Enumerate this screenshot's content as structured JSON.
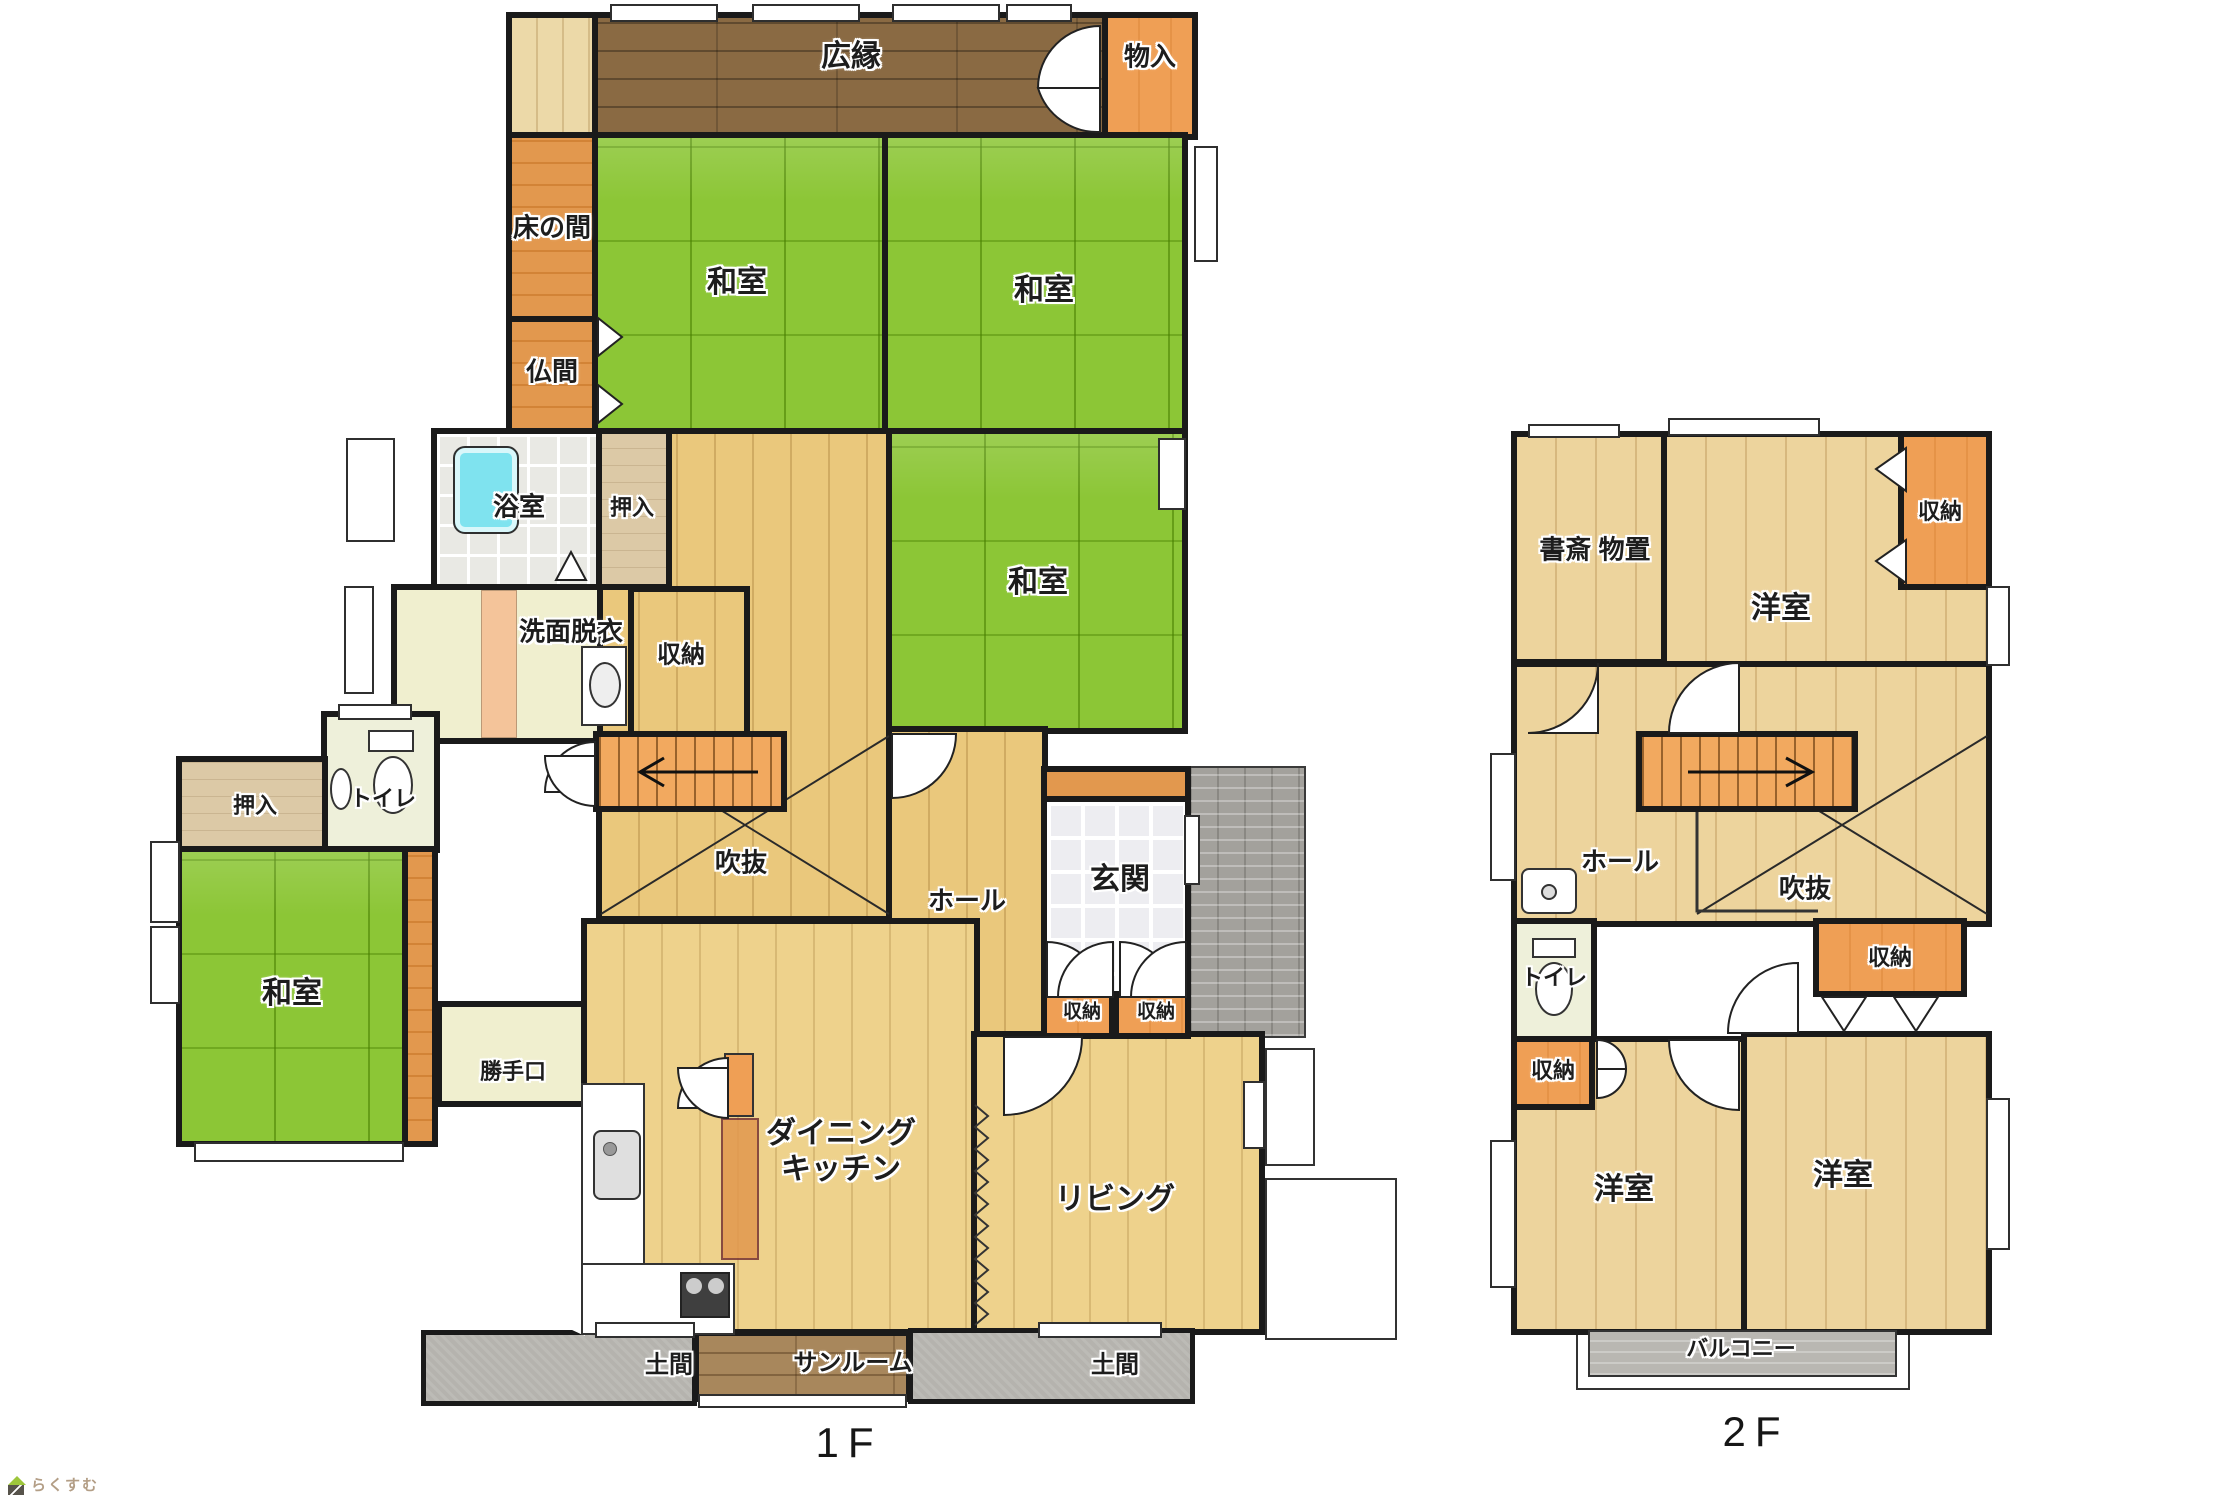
{
  "floor1": {
    "hiroen": "広縁",
    "monoire": "物入",
    "tokonoma": "床の間",
    "butsuma": "仏間",
    "washitsu_nw": "和室",
    "washitsu_ne": "和室",
    "washitsu_mid": "和室",
    "washitsu_w": "和室",
    "bath": "浴室",
    "oshiire_center": "押入",
    "oshiire_west": "押入",
    "senmen": "洗面脱衣",
    "shuno_center": "収納",
    "toilet": "トイレ",
    "fukinuke": "吹抜",
    "hall": "ホール",
    "genkan": "玄関",
    "shuno_genkan_1": "収納",
    "shuno_genkan_2": "収納",
    "katteguchi": "勝手口",
    "dk_line1": "ダイニング",
    "dk_line2": "キッチン",
    "living": "リビング",
    "doma_left": "土間",
    "sunroom": "サンルーム",
    "doma_right": "土間",
    "floor_label": "1F"
  },
  "floor2": {
    "shosai": "書斎 物置",
    "yoshitsu_n": "洋室",
    "shuno_ne": "収納",
    "hall": "ホール",
    "fukinuke": "吹抜",
    "toilet": "トイレ",
    "shuno_e": "収納",
    "shuno_sw": "収納",
    "yoshitsu_sw": "洋室",
    "yoshitsu_se": "洋室",
    "balcony": "バルコニー",
    "floor_label": "2F"
  },
  "logo": {
    "text": "らくすむ"
  },
  "palette": {
    "wall": "#1a1a1a",
    "tatami": "#8cc636",
    "wood": "#eac87c",
    "wood_light": "#eed28c",
    "wood_2f": "#edd49d",
    "hiroen_brown": "#8a6a43",
    "sunroom_brown": "#a8875c",
    "orange_storage": "#ef9f55",
    "orange_wood": "#e2984e",
    "oshiire_tan": "#dcc9a6",
    "stairs_orange": "#f2a95f",
    "cream": "#f0efcf",
    "pale_green": "#eef0da",
    "bath_tile": "#e9e9e4",
    "tub_cyan": "#7fe3ef",
    "genkan_tile": "#ededf1",
    "doma_gray": "#b5b3ae",
    "porch_gray": "#a3a19c",
    "balcony_gray": "#b9b7b2",
    "logo_text_color": "#b39e86",
    "logo_roof_green": "#9dc63b"
  }
}
